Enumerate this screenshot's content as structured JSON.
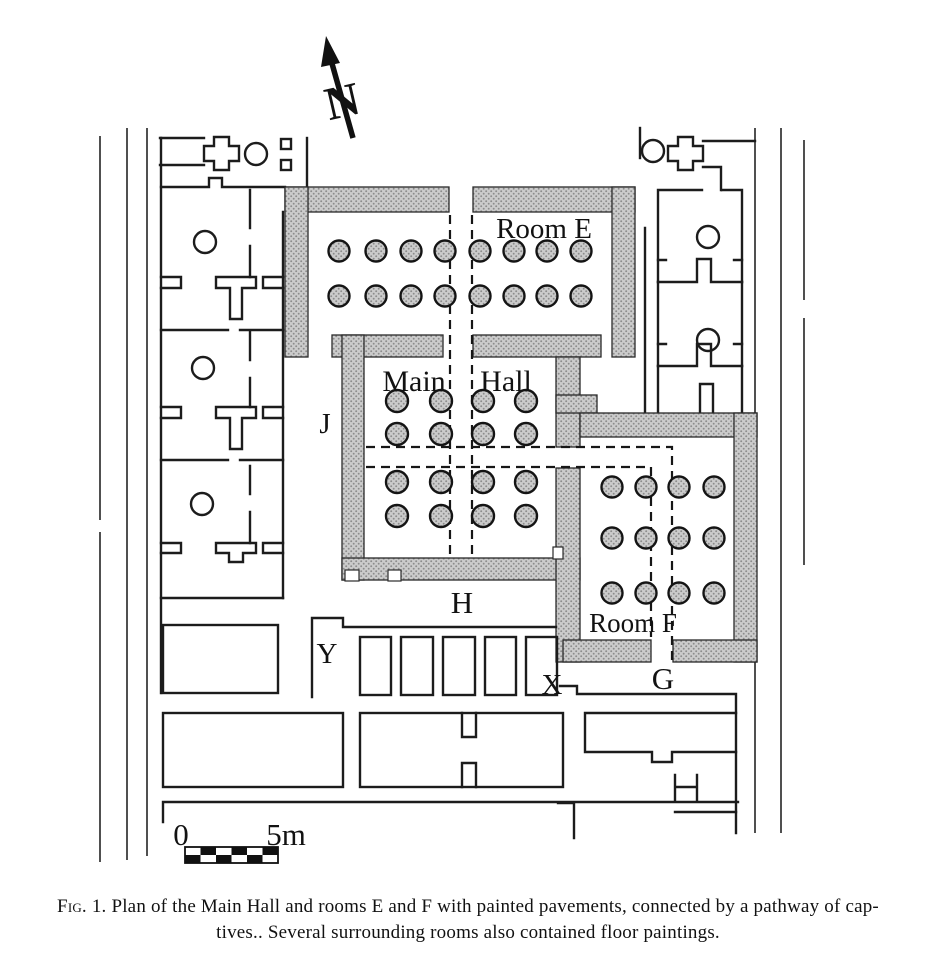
{
  "figure": {
    "labels": {
      "north": "N",
      "room_e": "Room E",
      "main": "Main",
      "hall": "Hall",
      "room_f": "Room F",
      "j": "J",
      "h": "H",
      "y": "Y",
      "x": "X",
      "g": "G"
    },
    "scale_bar": {
      "start": "0",
      "end": "5m"
    },
    "caption": {
      "fig_label": "Fig. 1.",
      "line1_rest": "Plan of the Main Hall and rooms E and F with painted pavements, connected by a pathway of cap-",
      "line2": "tives.. Several surrounding rooms also contained floor paintings."
    }
  }
}
